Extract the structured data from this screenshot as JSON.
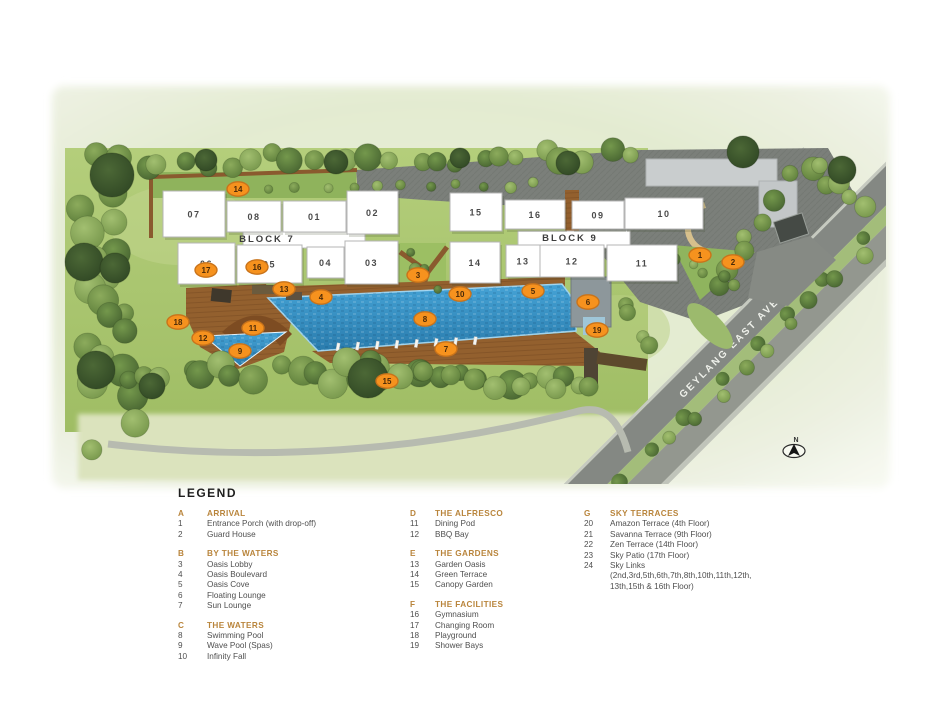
{
  "plan": {
    "road_label": "GEYLANG EAST AVE 1",
    "north_label": "N",
    "block_groups": [
      {
        "label": "BLOCK 7",
        "x": 267,
        "y": 242
      },
      {
        "label": "BLOCK 9",
        "x": 570,
        "y": 241
      }
    ],
    "blocks": [
      {
        "label": "07",
        "x": 163,
        "y": 191,
        "w": 62,
        "h": 46
      },
      {
        "label": "08",
        "x": 227,
        "y": 201,
        "w": 54,
        "h": 31
      },
      {
        "label": "01",
        "x": 283,
        "y": 201,
        "w": 63,
        "h": 31
      },
      {
        "label": "02",
        "x": 347,
        "y": 191,
        "w": 51,
        "h": 43
      },
      {
        "label": "06",
        "x": 178,
        "y": 243,
        "w": 57,
        "h": 41
      },
      {
        "label": "05",
        "x": 237,
        "y": 245,
        "w": 65,
        "h": 38
      },
      {
        "label": "04",
        "x": 307,
        "y": 247,
        "w": 37,
        "h": 31
      },
      {
        "label": "03",
        "x": 345,
        "y": 241,
        "w": 53,
        "h": 43
      },
      {
        "label": "15",
        "x": 450,
        "y": 193,
        "w": 52,
        "h": 38
      },
      {
        "label": "16",
        "x": 505,
        "y": 200,
        "w": 60,
        "h": 29
      },
      {
        "label": "09",
        "x": 572,
        "y": 201,
        "w": 52,
        "h": 28
      },
      {
        "label": "10",
        "x": 625,
        "y": 198,
        "w": 78,
        "h": 31
      },
      {
        "label": "14",
        "x": 450,
        "y": 242,
        "w": 50,
        "h": 41
      },
      {
        "label": "13",
        "x": 506,
        "y": 245,
        "w": 34,
        "h": 32
      },
      {
        "label": "12",
        "x": 540,
        "y": 245,
        "w": 64,
        "h": 32
      },
      {
        "label": "11",
        "x": 607,
        "y": 245,
        "w": 70,
        "h": 36
      }
    ],
    "markers": [
      {
        "num": "1",
        "x": 700,
        "y": 255
      },
      {
        "num": "2",
        "x": 733,
        "y": 262
      },
      {
        "num": "3",
        "x": 418,
        "y": 275
      },
      {
        "num": "4",
        "x": 321,
        "y": 297
      },
      {
        "num": "5",
        "x": 533,
        "y": 291
      },
      {
        "num": "6",
        "x": 588,
        "y": 302
      },
      {
        "num": "7",
        "x": 446,
        "y": 349
      },
      {
        "num": "8",
        "x": 425,
        "y": 319
      },
      {
        "num": "9",
        "x": 240,
        "y": 351
      },
      {
        "num": "10",
        "x": 460,
        "y": 294
      },
      {
        "num": "11",
        "x": 253,
        "y": 328
      },
      {
        "num": "12",
        "x": 203,
        "y": 338
      },
      {
        "num": "13",
        "x": 284,
        "y": 289
      },
      {
        "num": "14",
        "x": 238,
        "y": 189
      },
      {
        "num": "15",
        "x": 387,
        "y": 381
      },
      {
        "num": "16",
        "x": 257,
        "y": 267
      },
      {
        "num": "17",
        "x": 206,
        "y": 270
      },
      {
        "num": "18",
        "x": 178,
        "y": 322
      },
      {
        "num": "19",
        "x": 597,
        "y": 330
      }
    ],
    "colors": {
      "marker": "#f6921e",
      "marker_border": "#c9731a",
      "marker_text": "#4a2a08",
      "pool": "#3c98cc",
      "deck": "#94602f",
      "lawn": "#aecb72",
      "road": "#848883",
      "building": "#ffffff",
      "legend_heading": "#b9853c",
      "legend_text": "#4f4f4f"
    }
  },
  "legend": {
    "title": "LEGEND",
    "columns": [
      {
        "sections": [
          {
            "letter": "A",
            "title": "ARRIVAL",
            "items": [
              {
                "num": "1",
                "text": "Entrance Porch (with drop-off)"
              },
              {
                "num": "2",
                "text": "Guard House"
              }
            ]
          },
          {
            "letter": "B",
            "title": "BY THE WATERS",
            "items": [
              {
                "num": "3",
                "text": "Oasis Lobby"
              },
              {
                "num": "4",
                "text": "Oasis Boulevard"
              },
              {
                "num": "5",
                "text": "Oasis Cove"
              },
              {
                "num": "6",
                "text": "Floating Lounge"
              },
              {
                "num": "7",
                "text": "Sun Lounge"
              }
            ]
          },
          {
            "letter": "C",
            "title": "THE WATERS",
            "items": [
              {
                "num": "8",
                "text": "Swimming Pool"
              },
              {
                "num": "9",
                "text": "Wave Pool (Spas)"
              },
              {
                "num": "10",
                "text": "Infinity Fall"
              }
            ]
          }
        ]
      },
      {
        "sections": [
          {
            "letter": "D",
            "title": "THE ALFRESCO",
            "items": [
              {
                "num": "11",
                "text": "Dining Pod"
              },
              {
                "num": "12",
                "text": "BBQ Bay"
              }
            ]
          },
          {
            "letter": "E",
            "title": "THE GARDENS",
            "items": [
              {
                "num": "13",
                "text": "Garden Oasis"
              },
              {
                "num": "14",
                "text": "Green Terrace"
              },
              {
                "num": "15",
                "text": "Canopy Garden"
              }
            ]
          },
          {
            "letter": "F",
            "title": "THE FACILITIES",
            "items": [
              {
                "num": "16",
                "text": "Gymnasium"
              },
              {
                "num": "17",
                "text": "Changing Room"
              },
              {
                "num": "18",
                "text": "Playground"
              },
              {
                "num": "19",
                "text": "Shower Bays"
              }
            ]
          }
        ]
      },
      {
        "sections": [
          {
            "letter": "G",
            "title": "SKY TERRACES",
            "items": [
              {
                "num": "20",
                "text": "Amazon Terrace (4th Floor)"
              },
              {
                "num": "21",
                "text": "Savanna Terrace (9th Floor)"
              },
              {
                "num": "22",
                "text": "Zen Terrace (14th Floor)"
              },
              {
                "num": "23",
                "text": "Sky Patio (17th Floor)"
              },
              {
                "num": "24",
                "text": "Sky Links",
                "sub": [
                  "(2nd,3rd,5th,6th,7th,8th,10th,11th,12th,",
                  "13th,15th & 16th Floor)"
                ]
              }
            ]
          }
        ]
      }
    ]
  }
}
